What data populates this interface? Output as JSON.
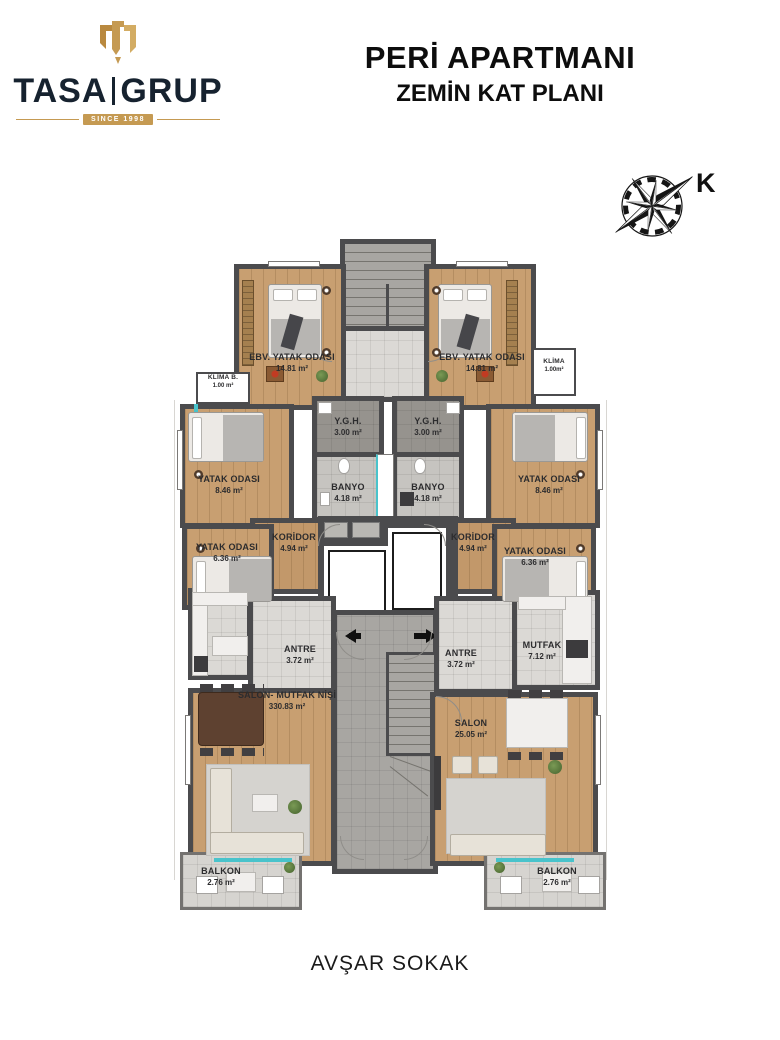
{
  "header": {
    "logo": {
      "brand_left": "TASA",
      "brand_right": "GRUP",
      "tagline": "SINCE 1998"
    },
    "title": "PERİ APARTMANI",
    "subtitle": "ZEMİN KAT PLANI"
  },
  "compass": {
    "north_label": "K"
  },
  "street_label": "AVŞAR SOKAK",
  "colors": {
    "wall": "#4B4B4D",
    "wood_floor": "#C89F71",
    "tile_light": "#DBD9D5",
    "tile_dark": "#96938E",
    "corridor_gray": "#A8A6A2",
    "accent_teal": "#49C3CB",
    "logo_gold": "#C59A52",
    "logo_navy": "#16222F"
  },
  "rooms": [
    {
      "name": "EBV. YATAK ODASI",
      "area": "14.81 m²"
    },
    {
      "name": "EBV. YATAK ODASI",
      "area": "14.81 m²"
    },
    {
      "name": "KLİMA B.",
      "area": "1.00 m²"
    },
    {
      "name": "KLİMA",
      "area": "1.00m²"
    },
    {
      "name": "Y.G.H.",
      "area": "3.00 m²"
    },
    {
      "name": "Y.G.H.",
      "area": "3.00 m²"
    },
    {
      "name": "BANYO",
      "area": "4.18 m²"
    },
    {
      "name": "BANYO",
      "area": "4.18 m²"
    },
    {
      "name": "YATAK ODASI",
      "area": "8.46 m²"
    },
    {
      "name": "YATAK ODASI",
      "area": "8.46 m²"
    },
    {
      "name": "KORİDOR",
      "area": "4.94 m²"
    },
    {
      "name": "KORİDOR",
      "area": "4.94 m²"
    },
    {
      "name": "YATAK ODASI",
      "area": "6.36 m²"
    },
    {
      "name": "YATAK ODASI",
      "area": "6.36 m²"
    },
    {
      "name": "ANTRE",
      "area": "3.72 m²"
    },
    {
      "name": "ANTRE",
      "area": "3.72 m²"
    },
    {
      "name": "MUTFAK",
      "area": "7.12 m²"
    },
    {
      "name": "SALON- MUTFAK NİŞİ",
      "area": "330.83 m²"
    },
    {
      "name": "SALON",
      "area": "25.05 m²"
    },
    {
      "name": "BALKON",
      "area": "2.76 m²"
    },
    {
      "name": "BALKON",
      "area": "2.76 m²"
    }
  ]
}
